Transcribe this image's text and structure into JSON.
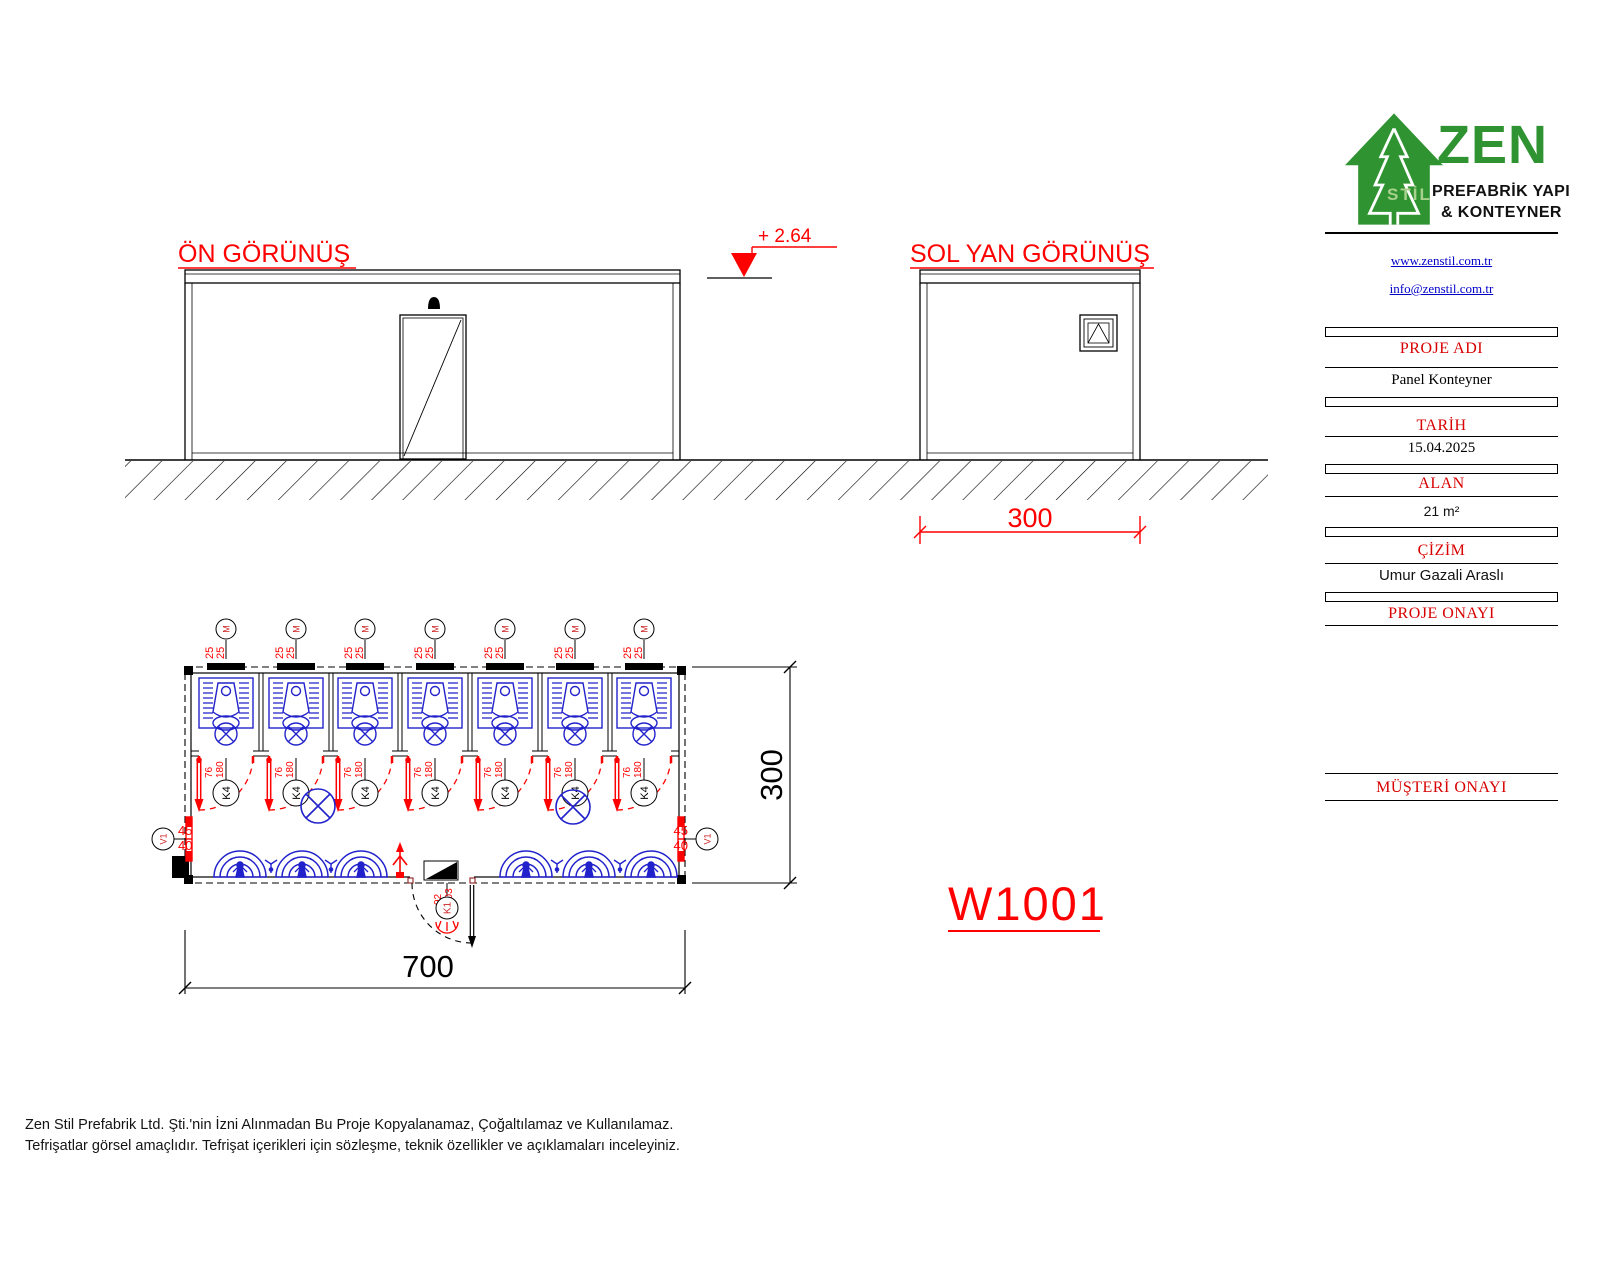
{
  "drawing": {
    "front_view_title": "ÖN GÖRÜNÜŞ",
    "side_view_title": "SOL YAN GÖRÜNÜŞ",
    "level_mark": "+ 2.64",
    "side_width_dim": "300",
    "plan_width_dim": "700",
    "plan_depth_dim": "300",
    "drawing_no": "W1001",
    "vent_tag": "M",
    "vent_w": "25",
    "vent_h": "25",
    "stall_door_tag": "K4",
    "stall_door_w": "76",
    "stall_door_h": "180",
    "window_tag": "V1",
    "window_w": "45",
    "window_h": "40",
    "main_door_tag": "K1",
    "main_door_w": "92",
    "main_door_h": "203"
  },
  "title_block": {
    "brand": {
      "zen": "ZEN",
      "stil": "STİL",
      "line1": "PREFABRİK YAPI",
      "line2": "& KONTEYNER"
    },
    "links": {
      "web": "www.zenstil.com.tr",
      "email": "info@zenstil.com.tr"
    },
    "sections": [
      {
        "label": "PROJE ADI",
        "value": "Panel Konteyner"
      },
      {
        "label": "TARİH",
        "value": "15.04.2025"
      },
      {
        "label": "ALAN",
        "value": "21 m²"
      },
      {
        "label": "ÇİZİM",
        "value": "Umur Gazali Araslı"
      },
      {
        "label": "PROJE ONAYI",
        "value": ""
      },
      {
        "label": "MÜŞTERİ ONAYI",
        "value": ""
      }
    ]
  },
  "footer": {
    "line1": "Zen Stil Prefabrik Ltd. Şti.'nin İzni Alınmadan Bu Proje Kopyalanamaz, Çoğaltılamaz ve Kullanılamaz.",
    "line2": "Tefrişatlar görsel amaçlıdır. Tefrişat içerikleri için sözleşme, teknik özellikler ve açıklamaları inceleyiniz."
  },
  "colors": {
    "drawing_red": "#ff0000",
    "fixture_blue": "#2222cc",
    "logo_green": "#2f9331",
    "logo_light_green": "#a9d18e",
    "link_blue": "#0000c8",
    "section_label_red": "#d80000"
  }
}
